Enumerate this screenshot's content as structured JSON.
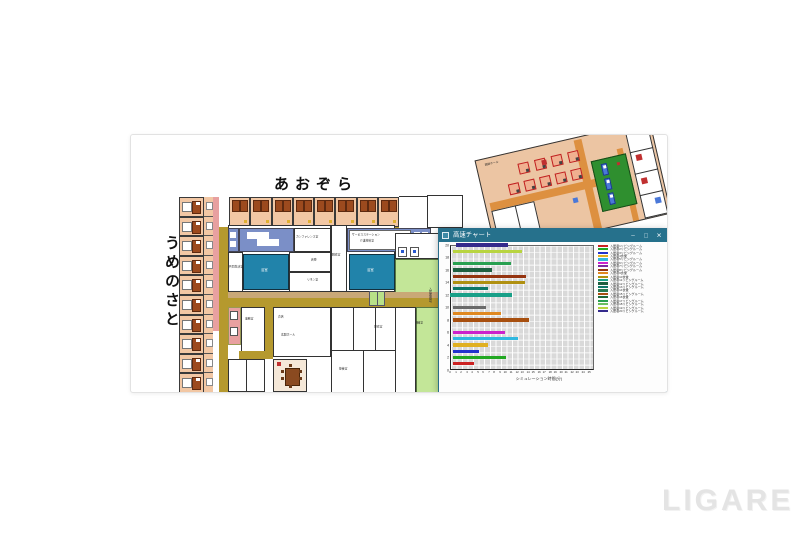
{
  "watermark": {
    "text": "LIGARE"
  },
  "floorplan": {
    "label_top": "あおぞら",
    "label_left": "うめのさと",
    "left_rooms_count": 10,
    "top_rooms_count": 8,
    "room_labels": {
      "conference": "カンファレンス室",
      "service_station_1": "サービスステーション",
      "service_station_2": "介護材料室",
      "bath_left": "浴室",
      "bath_right": "浴室",
      "living_left": "共同生活室",
      "linen": "リネン室",
      "storage": "倉庫",
      "dressing": "脱衣室",
      "office": "事務室",
      "shop": "売店",
      "entrance": "玄関ホール",
      "training": "機能訓練室",
      "rest": "静養室",
      "changing": "更衣室"
    }
  },
  "mini_plan": {
    "label": "談話ホール",
    "tables_row1": 4,
    "tables_row2": 5,
    "beds": 3
  },
  "chart_window": {
    "title": "高速チャート",
    "minimize": "–",
    "maximize": "□",
    "close": "✕"
  },
  "chart_data": {
    "type": "bar",
    "orientation": "horizontal",
    "title": "高速チャート",
    "xlabel": "シミュレーション時間(分)",
    "ylabel": "入居者番号",
    "xlim": [
      0,
      26
    ],
    "ylim": [
      0,
      20
    ],
    "grid": true,
    "legend_position": "right",
    "x_ticks": [
      0,
      1,
      2,
      3,
      4,
      5,
      6,
      7,
      8,
      9,
      10,
      11,
      12,
      13,
      14,
      15,
      16,
      17,
      18,
      19,
      20,
      21,
      22,
      23,
      24,
      25
    ],
    "y_ticks": [
      0,
      2,
      4,
      6,
      8,
      10,
      12,
      14,
      16,
      18,
      20
    ],
    "bars": [
      {
        "y": 1,
        "color": "#cc2222",
        "start": 0.5,
        "end": 4.3
      },
      {
        "y": 2,
        "color": "#22a822",
        "start": 0.5,
        "end": 10.2
      },
      {
        "y": 3,
        "color": "#2233cc",
        "start": 0.5,
        "end": 5.3
      },
      {
        "y": 4,
        "color": "#e0b020",
        "start": 0.5,
        "end": 6.8
      },
      {
        "y": 5,
        "color": "#30b8e0",
        "start": 0.5,
        "end": 12.2
      },
      {
        "y": 6,
        "color": "#cc22cc",
        "start": 0.5,
        "end": 10.0
      },
      {
        "y": 8,
        "color": "#a85010",
        "start": 0.5,
        "end": 14.3
      },
      {
        "y": 9,
        "color": "#e08820",
        "start": 0.5,
        "end": 9.2
      },
      {
        "y": 10,
        "color": "#6a6a6a",
        "start": 0.5,
        "end": 6.5
      },
      {
        "y": 12,
        "color": "#18a088",
        "start": 0.0,
        "end": 11.2
      },
      {
        "y": 13,
        "color": "#0e7868",
        "start": 0.5,
        "end": 6.8
      },
      {
        "y": 14,
        "color": "#b09010",
        "start": 0.5,
        "end": 13.5
      },
      {
        "y": 15,
        "color": "#953410",
        "start": 0.5,
        "end": 13.8
      },
      {
        "y": 16,
        "color": "#1e6040",
        "start": 0.5,
        "end": 7.5
      },
      {
        "y": 17,
        "color": "#28a050",
        "start": 0.5,
        "end": 11.0
      },
      {
        "y": 19,
        "color": "#b8d440",
        "start": 0.5,
        "end": 13.0
      },
      {
        "y": 20,
        "color": "#342a8c",
        "start": 1.0,
        "end": 10.5
      }
    ],
    "legend": [
      {
        "label": "入居者1リビングルーム",
        "color": "#cc2222"
      },
      {
        "label": "入居者2リビングルーム",
        "color": "#22a822"
      },
      {
        "label": "入居者3リビングルーム",
        "color": "#2233cc"
      },
      {
        "label": "入居者4食堂",
        "color": "#e0b020"
      },
      {
        "label": "入居者5リビングルーム",
        "color": "#30b8e0"
      },
      {
        "label": "入居者6リビングルーム",
        "color": "#cc22cc"
      },
      {
        "label": "入居者7リビングルーム",
        "color": "#7a2aa0"
      },
      {
        "label": "入居者8リビングルーム",
        "color": "#953410"
      },
      {
        "label": "入居者9食堂",
        "color": "#e08820"
      },
      {
        "label": "入居者10食堂",
        "color": "#b09010"
      },
      {
        "label": "入居者11リビングルーム",
        "color": "#18a088"
      },
      {
        "label": "入居者12リビングルーム",
        "color": "#1e6040"
      },
      {
        "label": "入居者13リビングルーム",
        "color": "#0e7868"
      },
      {
        "label": "入居者14食堂",
        "color": "#2a7a50"
      },
      {
        "label": "入居者15リビングルーム",
        "color": "#a85010"
      },
      {
        "label": "入居者16食堂",
        "color": "#206838"
      },
      {
        "label": "入居者17リビングルーム",
        "color": "#28a050"
      },
      {
        "label": "入居者18リビングルーム",
        "color": "#6abf60"
      },
      {
        "label": "入居者19リビングルーム",
        "color": "#b8d440"
      },
      {
        "label": "入居者20リビングルーム",
        "color": "#342a8c"
      }
    ]
  }
}
